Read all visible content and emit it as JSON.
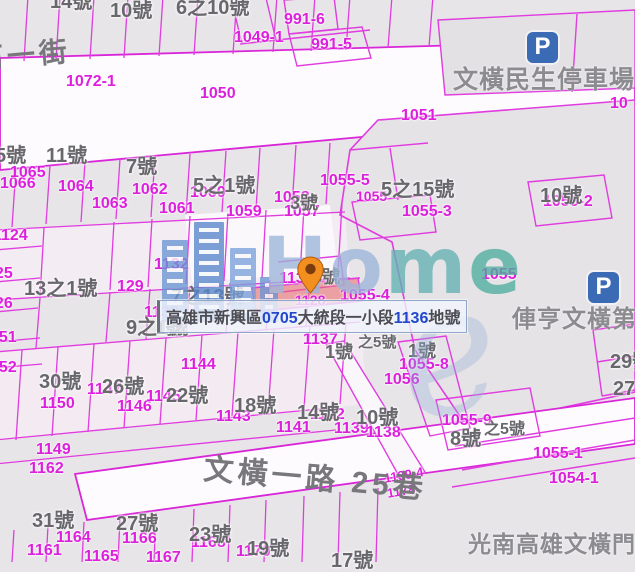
{
  "app": {
    "type": "cadastral-map-viewer"
  },
  "banner": {
    "segments": [
      {
        "t": "高雄市新興區",
        "c": "gray"
      },
      {
        "t": "0705",
        "c": "blue"
      },
      {
        "t": "大統段一小段",
        "c": "gray"
      },
      {
        "t": "1136",
        "c": "blue"
      },
      {
        "t": "地號",
        "c": "gray"
      }
    ]
  },
  "watermark": {
    "brand": "Home",
    "letters": [
      {
        "ch": "H",
        "color": "#9cb6da"
      },
      {
        "ch": "o",
        "color": "#9cb6da"
      },
      {
        "ch": "m",
        "color": "#64b2b4"
      },
      {
        "ch": "e",
        "color": "#4fae9f"
      }
    ],
    "swirl": "e"
  },
  "parking_glyph": "P",
  "parking_icons": [
    {
      "x": 527,
      "y": 32
    },
    {
      "x": 588,
      "y": 272
    }
  ],
  "pin": {
    "x": 297,
    "y": 256
  },
  "streets": [
    {
      "t": "河一街",
      "x": -26,
      "y": 46,
      "s": 28,
      "r": -5
    },
    {
      "t": "文橫一路 25巷",
      "x": 205,
      "y": 455,
      "s": 30,
      "r": 5
    }
  ],
  "pois": [
    {
      "t": "文橫民生停車場",
      "x": 453,
      "y": 68,
      "s": 25
    },
    {
      "t": "俥亨文橫第",
      "x": 512,
      "y": 308,
      "s": 24
    },
    {
      "t": "光南高雄文橫門",
      "x": 468,
      "y": 533,
      "s": 23
    }
  ],
  "parcel_labels": [
    {
      "t": "1049-1",
      "x": 234,
      "y": 30
    },
    {
      "t": "991-6",
      "x": 284,
      "y": 12
    },
    {
      "t": "991-5",
      "x": 311,
      "y": 37
    },
    {
      "t": "1072-1",
      "x": 66,
      "y": 74
    },
    {
      "t": "1050",
      "x": 200,
      "y": 86
    },
    {
      "t": "1051",
      "x": 401,
      "y": 108
    },
    {
      "t": "10",
      "x": 610,
      "y": 96
    },
    {
      "t": "1066",
      "x": 0,
      "y": 176
    },
    {
      "t": "1065",
      "x": 10,
      "y": 165
    },
    {
      "t": "1064",
      "x": 58,
      "y": 179
    },
    {
      "t": "1063",
      "x": 92,
      "y": 196
    },
    {
      "t": "1062",
      "x": 132,
      "y": 182
    },
    {
      "t": "1061",
      "x": 159,
      "y": 201
    },
    {
      "t": "1060",
      "x": 190,
      "y": 185
    },
    {
      "t": "1059",
      "x": 226,
      "y": 204
    },
    {
      "t": "1058",
      "x": 274,
      "y": 190
    },
    {
      "t": "1057",
      "x": 284,
      "y": 204
    },
    {
      "t": "1055-5",
      "x": 320,
      "y": 173
    },
    {
      "t": "1055",
      "x": 356,
      "y": 189,
      "s": 14
    },
    {
      "t": "1055-3",
      "x": 402,
      "y": 204
    },
    {
      "t": "1055-2",
      "x": 543,
      "y": 194
    },
    {
      "t": "1055",
      "x": 481,
      "y": 267
    },
    {
      "t": "1055-4",
      "x": 340,
      "y": 288
    },
    {
      "t": "1124",
      "x": -7,
      "y": 228
    },
    {
      "t": "1125",
      "x": -22,
      "y": 266
    },
    {
      "t": "1126",
      "x": -22,
      "y": 296
    },
    {
      "t": "1151",
      "x": -18,
      "y": 330
    },
    {
      "t": "1152",
      "x": -18,
      "y": 360
    },
    {
      "t": "1132",
      "x": 154,
      "y": 257
    },
    {
      "t": "129",
      "x": 117,
      "y": 279
    },
    {
      "t": "1133",
      "x": 144,
      "y": 305
    },
    {
      "t": "1135",
      "x": 279,
      "y": 271
    },
    {
      "t": "1128",
      "x": 295,
      "y": 293,
      "s": 14
    },
    {
      "t": "1137",
      "x": 303,
      "y": 332
    },
    {
      "t": "1056",
      "x": 384,
      "y": 372
    },
    {
      "t": "1055-8",
      "x": 399,
      "y": 357
    },
    {
      "t": "1055-9",
      "x": 442,
      "y": 413
    },
    {
      "t": "1055-1",
      "x": 533,
      "y": 446
    },
    {
      "t": "1054-1",
      "x": 549,
      "y": 471
    },
    {
      "t": "1150",
      "x": 40,
      "y": 396
    },
    {
      "t": "1147",
      "x": 87,
      "y": 382
    },
    {
      "t": "1146",
      "x": 117,
      "y": 399
    },
    {
      "t": "1145",
      "x": 146,
      "y": 389
    },
    {
      "t": "1144",
      "x": 181,
      "y": 357
    },
    {
      "t": "1143",
      "x": 216,
      "y": 409
    },
    {
      "t": "1142",
      "x": 310,
      "y": 407
    },
    {
      "t": "1141",
      "x": 276,
      "y": 420
    },
    {
      "t": "1139",
      "x": 334,
      "y": 421
    },
    {
      "t": "1138",
      "x": 366,
      "y": 425
    },
    {
      "t": "1149",
      "x": 36,
      "y": 442
    },
    {
      "t": "1162",
      "x": 29,
      "y": 461
    },
    {
      "t": "1161",
      "x": 27,
      "y": 543
    },
    {
      "t": "1164",
      "x": 56,
      "y": 530
    },
    {
      "t": "1165",
      "x": 84,
      "y": 549
    },
    {
      "t": "1166",
      "x": 122,
      "y": 531
    },
    {
      "t": "1167",
      "x": 146,
      "y": 550
    },
    {
      "t": "1168",
      "x": 191,
      "y": 535
    },
    {
      "t": "1170",
      "x": 236,
      "y": 544
    },
    {
      "t": "1139-4",
      "x": 383,
      "y": 472,
      "s": 13,
      "r": -10
    },
    {
      "t": "1178",
      "x": 386,
      "y": 487,
      "s": 13,
      "r": -10
    }
  ],
  "house_labels": [
    {
      "t": "14號",
      "x": 50,
      "y": -8
    },
    {
      "t": "10號",
      "x": 110,
      "y": 1
    },
    {
      "t": "6之10號",
      "x": 176,
      "y": -2
    },
    {
      "t": "5號",
      "x": -5,
      "y": 146
    },
    {
      "t": "11號",
      "x": 46,
      "y": 146
    },
    {
      "t": "7號",
      "x": 126,
      "y": 157
    },
    {
      "t": "5之1號",
      "x": 193,
      "y": 176
    },
    {
      "t": "5之15號",
      "x": 381,
      "y": 180
    },
    {
      "t": "3號",
      "x": 290,
      "y": 194,
      "s": 18
    },
    {
      "t": "10號",
      "x": 540,
      "y": 186
    },
    {
      "t": "13之1號",
      "x": 24,
      "y": 279
    },
    {
      "t": "7之13號",
      "x": 171,
      "y": 287
    },
    {
      "t": "9之1號",
      "x": 126,
      "y": 318
    },
    {
      "t": "1號",
      "x": 156,
      "y": 320,
      "s": 17
    },
    {
      "t": "5號",
      "x": 312,
      "y": 268,
      "s": 18
    },
    {
      "t": "1號",
      "x": 325,
      "y": 343,
      "s": 18
    },
    {
      "t": "之5號",
      "x": 358,
      "y": 335,
      "s": 15
    },
    {
      "t": "1號",
      "x": 408,
      "y": 342,
      "s": 18
    },
    {
      "t": "30號",
      "x": 39,
      "y": 372
    },
    {
      "t": "26號",
      "x": 102,
      "y": 377
    },
    {
      "t": "22號",
      "x": 166,
      "y": 386
    },
    {
      "t": "18號",
      "x": 234,
      "y": 396
    },
    {
      "t": "14號",
      "x": 297,
      "y": 403
    },
    {
      "t": "10號",
      "x": 356,
      "y": 408
    },
    {
      "t": "8號",
      "x": 450,
      "y": 429
    },
    {
      "t": "之5號",
      "x": 484,
      "y": 422,
      "s": 16
    },
    {
      "t": "29號",
      "x": 610,
      "y": 352
    },
    {
      "t": "27號",
      "x": 613,
      "y": 379
    },
    {
      "t": "31號",
      "x": 32,
      "y": 511
    },
    {
      "t": "27號",
      "x": 116,
      "y": 514
    },
    {
      "t": "23號",
      "x": 189,
      "y": 525
    },
    {
      "t": "19號",
      "x": 247,
      "y": 539
    },
    {
      "t": "17號",
      "x": 331,
      "y": 551
    }
  ],
  "colors": {
    "parcel_line": "#e03ce0",
    "parcel_text": "#dd1fdd",
    "house_text": "#67676c",
    "highlight_fill": "rgba(236,106,106,0.55)",
    "banner_blue": "#2247cb",
    "banner_gray": "#4c4c52"
  }
}
